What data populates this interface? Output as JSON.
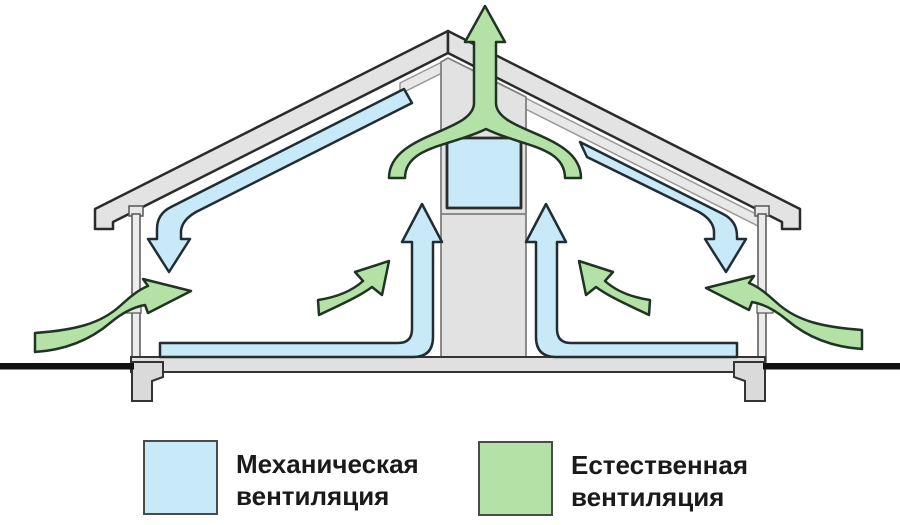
{
  "diagram": {
    "type": "house-roof-ventilation-cross-section",
    "legend": {
      "items": [
        {
          "id": "mechanical",
          "swatch_color": "#c7e9f8",
          "label": "Механическая вентиляция",
          "lines": [
            "Механическая",
            "вентиляция"
          ]
        },
        {
          "id": "natural",
          "swatch_color": "#b4e2a6",
          "label": "Естественная вентиляция",
          "lines": [
            "Естественная",
            "вентиляция"
          ]
        }
      ]
    },
    "colors": {
      "mechanical_flow": "#c7e9f8",
      "natural_flow": "#b4e2a6",
      "structure_fill": "#e3e3e3",
      "duct_fill": "#e2e2e2",
      "outline_dark": "#222222",
      "ground_line": "#111111",
      "background": "#ffffff"
    }
  }
}
